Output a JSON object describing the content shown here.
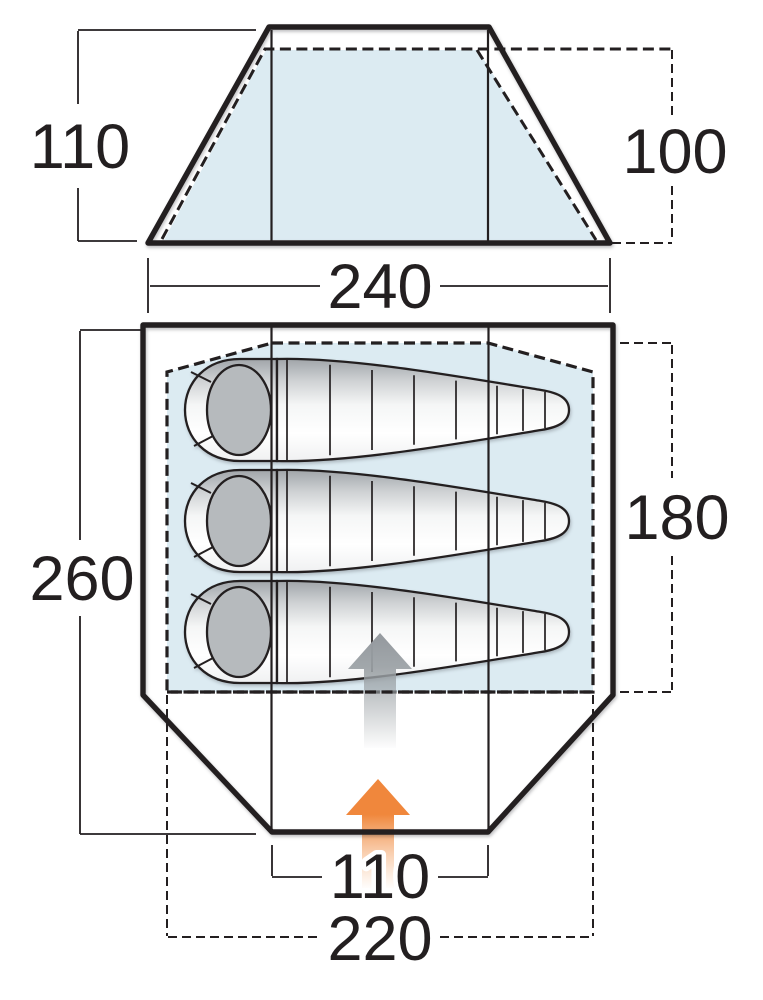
{
  "front_view": {
    "outer_height": "110",
    "inner_height": "100",
    "width": "240"
  },
  "floor_plan": {
    "outer_length": "260",
    "inner_length": "180",
    "door_width": "110",
    "inner_width": "220"
  },
  "icons": {
    "entrance_arrow": "arrow-up",
    "inner_direction_arrow": "arrow-up"
  },
  "colors": {
    "inner_fill_blue": "#dcebf2",
    "outline_black": "#231f20",
    "entrance_orange": "#f0873c",
    "direction_grey": "#9aa0a4",
    "bag_grey": "#b6babd"
  }
}
